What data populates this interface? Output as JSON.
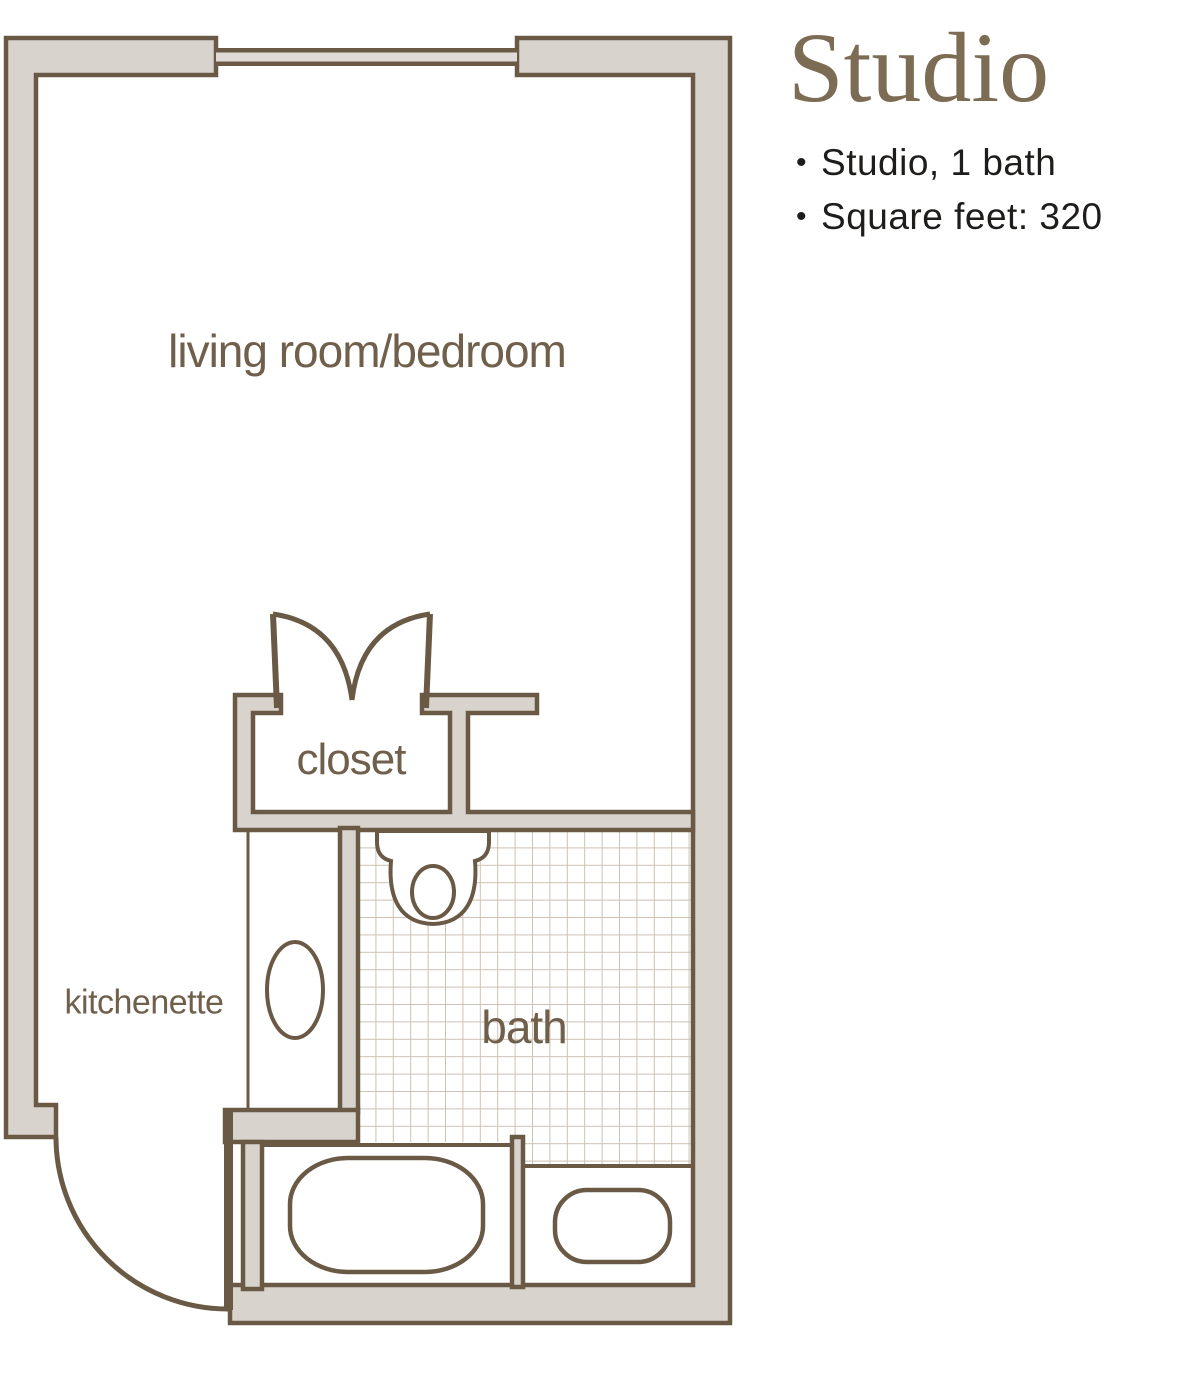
{
  "info_panel": {
    "title": "Studio",
    "bullets": [
      "Studio, 1 bath",
      "Square feet: 320"
    ]
  },
  "floor_plan": {
    "rooms": {
      "living": "living room/bedroom",
      "closet": "closet",
      "kitchenette": "kitchenette",
      "bath": "bath"
    },
    "fixtures": [
      "window",
      "closet-double-doors",
      "entry-door",
      "kitchenette-sink",
      "toilet",
      "bathtub",
      "bathroom-sink",
      "tiled-floor"
    ],
    "colors": {
      "wall_fill": "#d9d3ce",
      "wall_outline": "#6a5a45",
      "room_label_text": "#6f5f4b",
      "title_text": "#7d6c54",
      "bullet_text": "#1e1d1b",
      "tile_line": "#cdc1b3"
    }
  }
}
